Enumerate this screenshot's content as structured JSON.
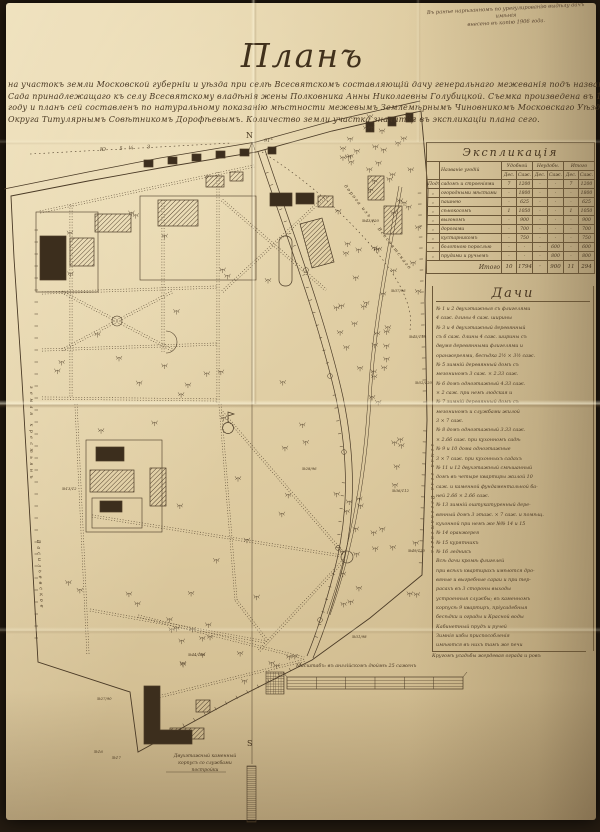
{
  "photo_note": {
    "line1": "Въ ранѣе нарѣзанномъ по урегулированію выдѣлу дачъ имѣнія",
    "line2": "внесено въ копію 1906 года."
  },
  "title": "Планъ",
  "subtitle_lines": [
    "на участокъ земли Московской губерніи и уѣзда при селѣ Всесвятскомъ составляющій дачу генеральнаго межеванія подъ названіемъ",
    "Сада принадлежащаго къ селу Всесвятскому владѣнія жены Полковника Анны Николаевны Голубицкой. Съемка произведена въ 1906",
    "году и планъ сей составленъ по натуральному показанію мѣстности межевымъ Землемѣрнымъ Чиновникомъ Московскаго Уѣзднаго",
    "Округа Титулярнымъ Совѣтникомъ Дорофѣевымъ. Количество земли участка значится въ экспликаціи плана сего."
  ],
  "explication": {
    "title": "Экспликація",
    "corner_header": "",
    "name_header": "Названіе угодій",
    "group_headers": [
      "Удобной",
      "Неудобн.",
      "Итого"
    ],
    "sub_headers": [
      "Дес.",
      "Саж.",
      "Дес.",
      "Саж.",
      "Дес.",
      "Саж."
    ],
    "rows": [
      {
        "pre": "Подъ",
        "name": "садомъ и строеніями",
        "values": [
          "7",
          "1200",
          "·",
          "·",
          "7",
          "1200"
        ]
      },
      {
        "pre": "„",
        "name": "огородными мѣстами",
        "values": [
          "·",
          "1800",
          "·",
          "·",
          "·",
          "1800"
        ]
      },
      {
        "pre": "„",
        "name": "пашнею",
        "values": [
          "·",
          "625",
          "·",
          "·",
          "·",
          "625"
        ]
      },
      {
        "pre": "„",
        "name": "сѣнокосомъ",
        "values": [
          "1",
          "1050",
          "·",
          "·",
          "1",
          "1050"
        ]
      },
      {
        "pre": "„",
        "name": "выгономъ",
        "values": [
          "·",
          "900",
          "·",
          "·",
          "·",
          "900"
        ]
      },
      {
        "pre": "„",
        "name": "дорогами",
        "values": [
          "·",
          "700",
          "·",
          "·",
          "·",
          "700"
        ]
      },
      {
        "pre": "„",
        "name": "кустарникомъ",
        "values": [
          "·",
          "750",
          "·",
          "·",
          "·",
          "750"
        ]
      },
      {
        "pre": "„",
        "name": "болотною порослью",
        "values": [
          "·",
          "·",
          "·",
          "600",
          "·",
          "600"
        ]
      },
      {
        "pre": "„",
        "name": "прудами и ручьемъ",
        "values": [
          "·",
          "·",
          "·",
          "800",
          "·",
          "800"
        ]
      }
    ],
    "total_label": "Итого",
    "total_values": [
      "10",
      "1794",
      "·",
      "900",
      "11",
      "294"
    ]
  },
  "dachi": {
    "title": "Дачи",
    "lines": [
      "№ 1 и 2 двухэтажныя съ флигелями",
      "4 саж. длины 4 саж. ширины",
      "№ 3 и 4 двухэтажный деревянный",
      "съ 6 саж. длины 4 саж. ширины съ",
      "двумя деревянными флигелями и",
      "оранжереями, бесѣдка 2½ × 3½ саж.",
      "№ 5 зимній деревянный домъ съ",
      "мезониномъ 3 саж. × 2.33 саж.",
      "№ 6 домъ одноэтажный 4.33 саж.",
      "× 2 саж. при немъ людская и",
      "№ 7 зимній деревянный домъ съ",
      "мезониномъ и службами жилой",
      "3 × 7 саж.",
      "№ 8 домъ одноэтажный 3.33 саж.",
      "× 2.66 саж. при кухонномъ садѣ",
      "№ 9 и 10 дома одноэтажные",
      "3 × 7 саж. при кухонныхъ садахъ",
      "№ 11 и 12 двухэтажный смѣшанный",
      "домъ въ четыре квартиры жилой 10",
      "саж. и каменной фундаментальной ба-",
      "ней 2.66 × 2.66 саж.",
      "№ 13 зимній оштукатуренный дере-",
      "вянный домъ 3 этаж. × 7 саж. и помѣщ.",
      "кухонной при немъ же №№ 14 и 15",
      "№ 14 оранжерея",
      "№ 15 курятникъ",
      "№ 16 ледникъ",
      "Всѣ дачи кромѣ флигелей",
      "при всѣхъ квартирахъ имѣются дро-",
      "вяные и выгребные сараи и при тер-",
      "расахъ въ 3 стороны выходы",
      "устроенныя службы; въ каменномъ",
      "корпусѣ 9 квартиръ, пріусадебныя",
      "бесѣдки и ограды и Красной воды",
      "Кабинетный прудъ и ручей",
      "Зимнія избы приспособленія",
      "имѣются въ нихъ тамъ же печи"
    ],
    "footnote": "Кругомъ усадьбы жердевая ограда и ровъ"
  },
  "map": {
    "north_label": "N",
    "south_label": "S",
    "angle_label": "91°",
    "bearing_label": "Ю 5¼ З",
    "road_label": "дорога изъ с. Всесвятскаго",
    "left_vertical_label_upper": "земля крестьянъ",
    "left_vertical_label_lower": "Васильевское",
    "right_vertical_label": "земля села Всесвятскаго",
    "building_caption": [
      "Двухэтажный каменный",
      "корпусъ со службами",
      "постройки"
    ],
    "small_building_labels": [
      "№16",
      "№17"
    ],
    "left_point_label": "№13/12",
    "point_labels": [
      "№43/120",
      "№37/96",
      "№45/118",
      "№52/120",
      "№28/96",
      "№36/112",
      "№49/120",
      "№31/98",
      "№44/116",
      "№27/90"
    ],
    "scale_caption": "Масштабъ: въ англійскомъ дюймѣ 25 саженъ"
  }
}
